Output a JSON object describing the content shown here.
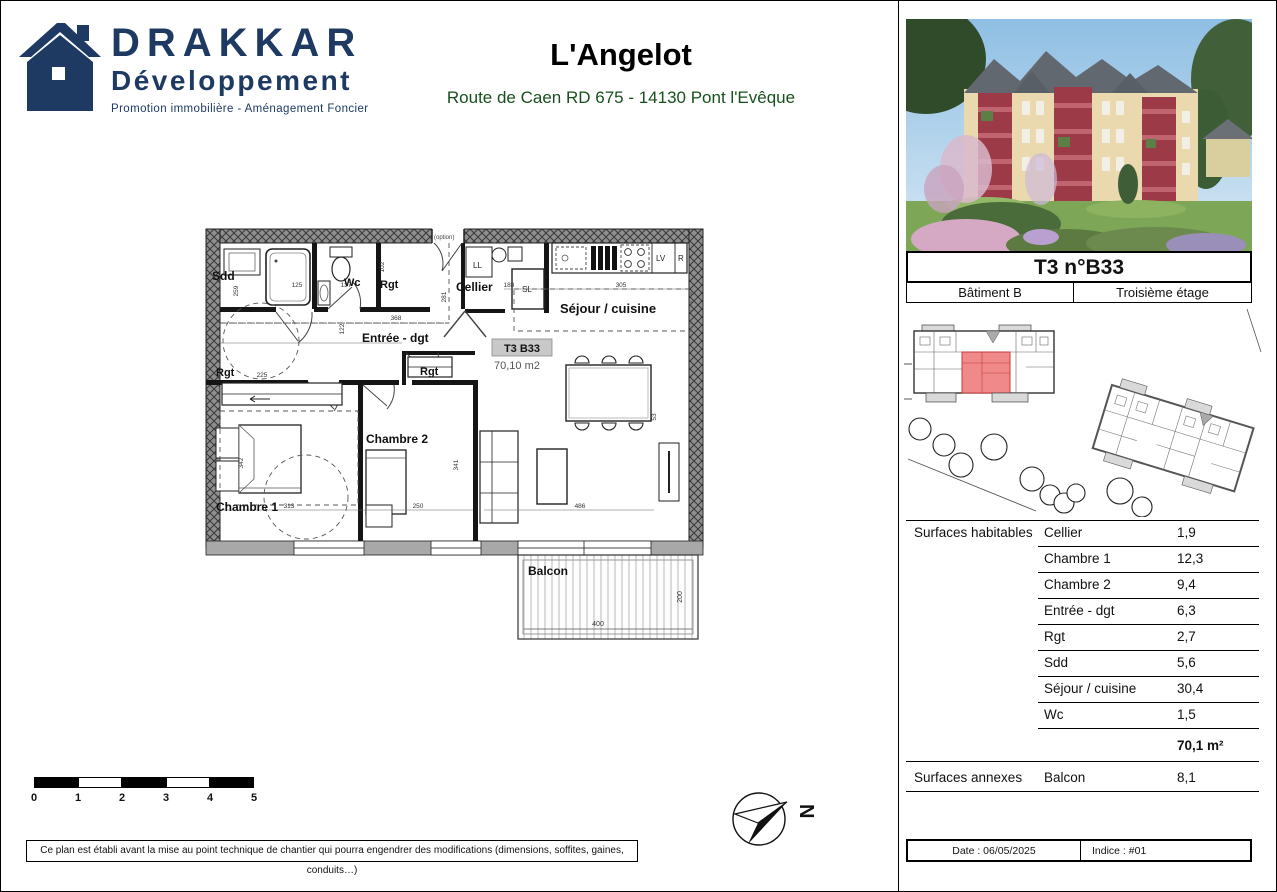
{
  "brand": {
    "name": "DRAKKAR",
    "division": "Développement",
    "tagline": "Promotion immobilière - Aménagement Foncier"
  },
  "header": {
    "title": "L'Angelot",
    "subtitle": "Route de Caen RD 675 - 14130 Pont l'Evêque"
  },
  "plan": {
    "unit_label": "T3 B33",
    "unit_area": "70,10 m2",
    "rooms": {
      "sdd": "Sdd",
      "wc": "Wc",
      "rgt_top": "Rgt",
      "rgt_left": "Rgt",
      "rgt_mid": "Rgt",
      "cellier": "Cellier",
      "sejour": "Séjour / cuisine",
      "entree": "Entrée - dgt",
      "chambre1": "Chambre 1",
      "chambre2": "Chambre 2",
      "balcon": "Balcon"
    },
    "appliances": {
      "ll": "LL",
      "sl": "SL",
      "lv": "LV",
      "r": "R"
    },
    "option_note": "(option)",
    "dims": [
      "259",
      "125",
      "137",
      "102",
      "368",
      "281",
      "122",
      "225",
      "188",
      "305",
      "313",
      "342",
      "250",
      "341",
      "486",
      "53",
      "400",
      "200"
    ]
  },
  "scalebar": {
    "labels": [
      "0",
      "1",
      "2",
      "3",
      "4",
      "5"
    ]
  },
  "north": {
    "letter": "N"
  },
  "disclaimer": "Ce plan est établi avant la mise au point technique de chantier qui pourra engendrer des modifications (dimensions, soffites, gaines, conduits…)",
  "sidebar": {
    "unit_title": "T3 n°B33",
    "building": "Bâtiment B",
    "floor": "Troisième étage",
    "surfaces_habitables": {
      "label": "Surfaces habitables",
      "rows": [
        {
          "room": "Cellier",
          "area": "1,9"
        },
        {
          "room": "Chambre 1",
          "area": "12,3"
        },
        {
          "room": "Chambre 2",
          "area": "9,4"
        },
        {
          "room": "Entrée - dgt",
          "area": "6,3"
        },
        {
          "room": "Rgt",
          "area": "2,7"
        },
        {
          "room": "Sdd",
          "area": "5,6"
        },
        {
          "room": "Séjour / cuisine",
          "area": "30,4"
        },
        {
          "room": "Wc",
          "area": "1,5"
        }
      ],
      "total": "70,1 m²"
    },
    "surfaces_annexes": {
      "label": "Surfaces annexes",
      "room": "Balcon",
      "area": "8,1"
    },
    "footer": {
      "date": "Date : 06/05/2025",
      "indice": "Indice : #01"
    }
  },
  "colors": {
    "brand_navy": "#1e3a63",
    "subtitle_green": "#17501c",
    "unit_highlight": "#f08a8a"
  }
}
